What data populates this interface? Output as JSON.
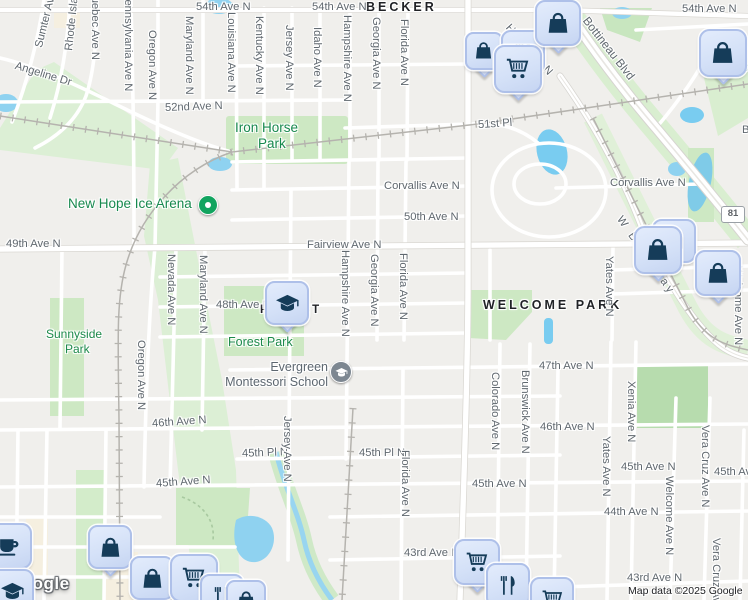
{
  "map": {
    "neighborhoods": [
      {
        "text": "BECKER"
      },
      {
        "text": "FOREST"
      },
      {
        "text": "WELCOME PARK"
      }
    ],
    "streets_h": [
      {
        "text": "54th Ave N"
      },
      {
        "text": "54th Ave N"
      },
      {
        "text": "54th Ave N"
      },
      {
        "text": "52nd Ave N"
      },
      {
        "text": "51st Pl"
      },
      {
        "text": "Corvallis Ave N"
      },
      {
        "text": "Corvallis Ave N"
      },
      {
        "text": "50th Ave N"
      },
      {
        "text": "49th Ave N"
      },
      {
        "text": "Fairview Ave N"
      },
      {
        "text": "48th Ave N"
      },
      {
        "text": "47th Ave N"
      },
      {
        "text": "46th Ave N"
      },
      {
        "text": "46th Ave N"
      },
      {
        "text": "45th Pl N"
      },
      {
        "text": "45th Pl N"
      },
      {
        "text": "45th Ave N"
      },
      {
        "text": "45th Ave N"
      },
      {
        "text": "45th Ave N"
      },
      {
        "text": "45th Ave N"
      },
      {
        "text": "44th Ave N"
      },
      {
        "text": "43rd Ave N"
      },
      {
        "text": "43rd Ave N"
      }
    ],
    "streets_v": [
      {
        "text": "Quebec Ave N"
      },
      {
        "text": "Pennsylvania Ave N"
      },
      {
        "text": "Oregon Ave N"
      },
      {
        "text": "Maryland Ave N"
      },
      {
        "text": "Louisiana Ave N"
      },
      {
        "text": "Kentucky Ave N"
      },
      {
        "text": "Jersey Ave N"
      },
      {
        "text": "Idaho Ave N"
      },
      {
        "text": "Hampshire Ave N"
      },
      {
        "text": "Georgia Ave N"
      },
      {
        "text": "Florida Ave N"
      },
      {
        "text": "Nevada Ave N"
      },
      {
        "text": "Maryland Ave N"
      },
      {
        "text": "Oregon Ave N"
      },
      {
        "text": "Hampshire Ave N"
      },
      {
        "text": "Georgia Ave N"
      },
      {
        "text": "Florida Ave N"
      },
      {
        "text": "Jersey Ave N"
      },
      {
        "text": "Florida Ave N"
      },
      {
        "text": "Colorado Ave N"
      },
      {
        "text": "Brunswick Ave N"
      },
      {
        "text": "Yates Ave N"
      },
      {
        "text": "Yates Ave N"
      },
      {
        "text": "Xenia Ave N"
      },
      {
        "text": "Welcome Ave N"
      },
      {
        "text": "Welcome Ave N"
      },
      {
        "text": "Vera Cruz Ave N"
      },
      {
        "text": "Vera Cruz Ave N"
      }
    ],
    "streets_diag": [
      {
        "text": "Sumter Ave"
      },
      {
        "text": "Rhode Island Ave"
      },
      {
        "text": "Angeline Dr"
      },
      {
        "text": "Hanson Ct N"
      },
      {
        "text": "Bottineau Blvd"
      },
      {
        "text": "W Broadway"
      }
    ],
    "parks": [
      {
        "text": "Iron Horse"
      },
      {
        "text": "Park"
      },
      {
        "text": "Sunnyside"
      },
      {
        "text": "Park"
      },
      {
        "text": "Forest Park"
      },
      {
        "text": "Soc"
      }
    ],
    "pois": [
      {
        "text": "New Hope Ice Arena",
        "type": "ice-arena"
      },
      {
        "line1": "Evergreen",
        "line2": "Montessori School",
        "type": "school"
      }
    ],
    "route_shield": {
      "text": "81"
    },
    "edge_labels": [
      {
        "text": "B"
      }
    ],
    "pins": [
      {
        "icon": "shopping-bag"
      },
      {
        "icon": "grocery-store"
      },
      {
        "icon": "shopping-cart"
      },
      {
        "icon": "shopping-bag"
      },
      {
        "icon": "shopping-bag"
      },
      {
        "icon": "grocery-store"
      },
      {
        "icon": "shopping-bag"
      },
      {
        "icon": "shopping-bag"
      },
      {
        "icon": "school"
      },
      {
        "icon": "coffee"
      },
      {
        "icon": "school"
      },
      {
        "icon": "shopping-bag"
      },
      {
        "icon": "shopping-bag"
      },
      {
        "icon": "shopping-cart"
      },
      {
        "icon": "restaurant"
      },
      {
        "icon": "shopping-cart"
      },
      {
        "icon": "restaurant"
      },
      {
        "icon": "shopping-cart"
      },
      {
        "icon": "shopping-bag"
      }
    ]
  },
  "colors": {
    "park_green": "#cde8c3",
    "park_pale": "#dcefd5",
    "park_dark": "#b7dcae",
    "water": "#8fd2f0",
    "road": "#ffffff",
    "rail": "#b5b3ae",
    "pin_fill": "#d8e3f8",
    "pin_border": "#aec0e9",
    "pin_glyph": "#153c59",
    "poi_green": "#12a45f",
    "poi_gray": "#7d8791",
    "label_green": "#1d8a4b"
  },
  "attribution": {
    "text": "Map data ©2025 Google"
  },
  "watermark": {
    "text": "Google"
  }
}
